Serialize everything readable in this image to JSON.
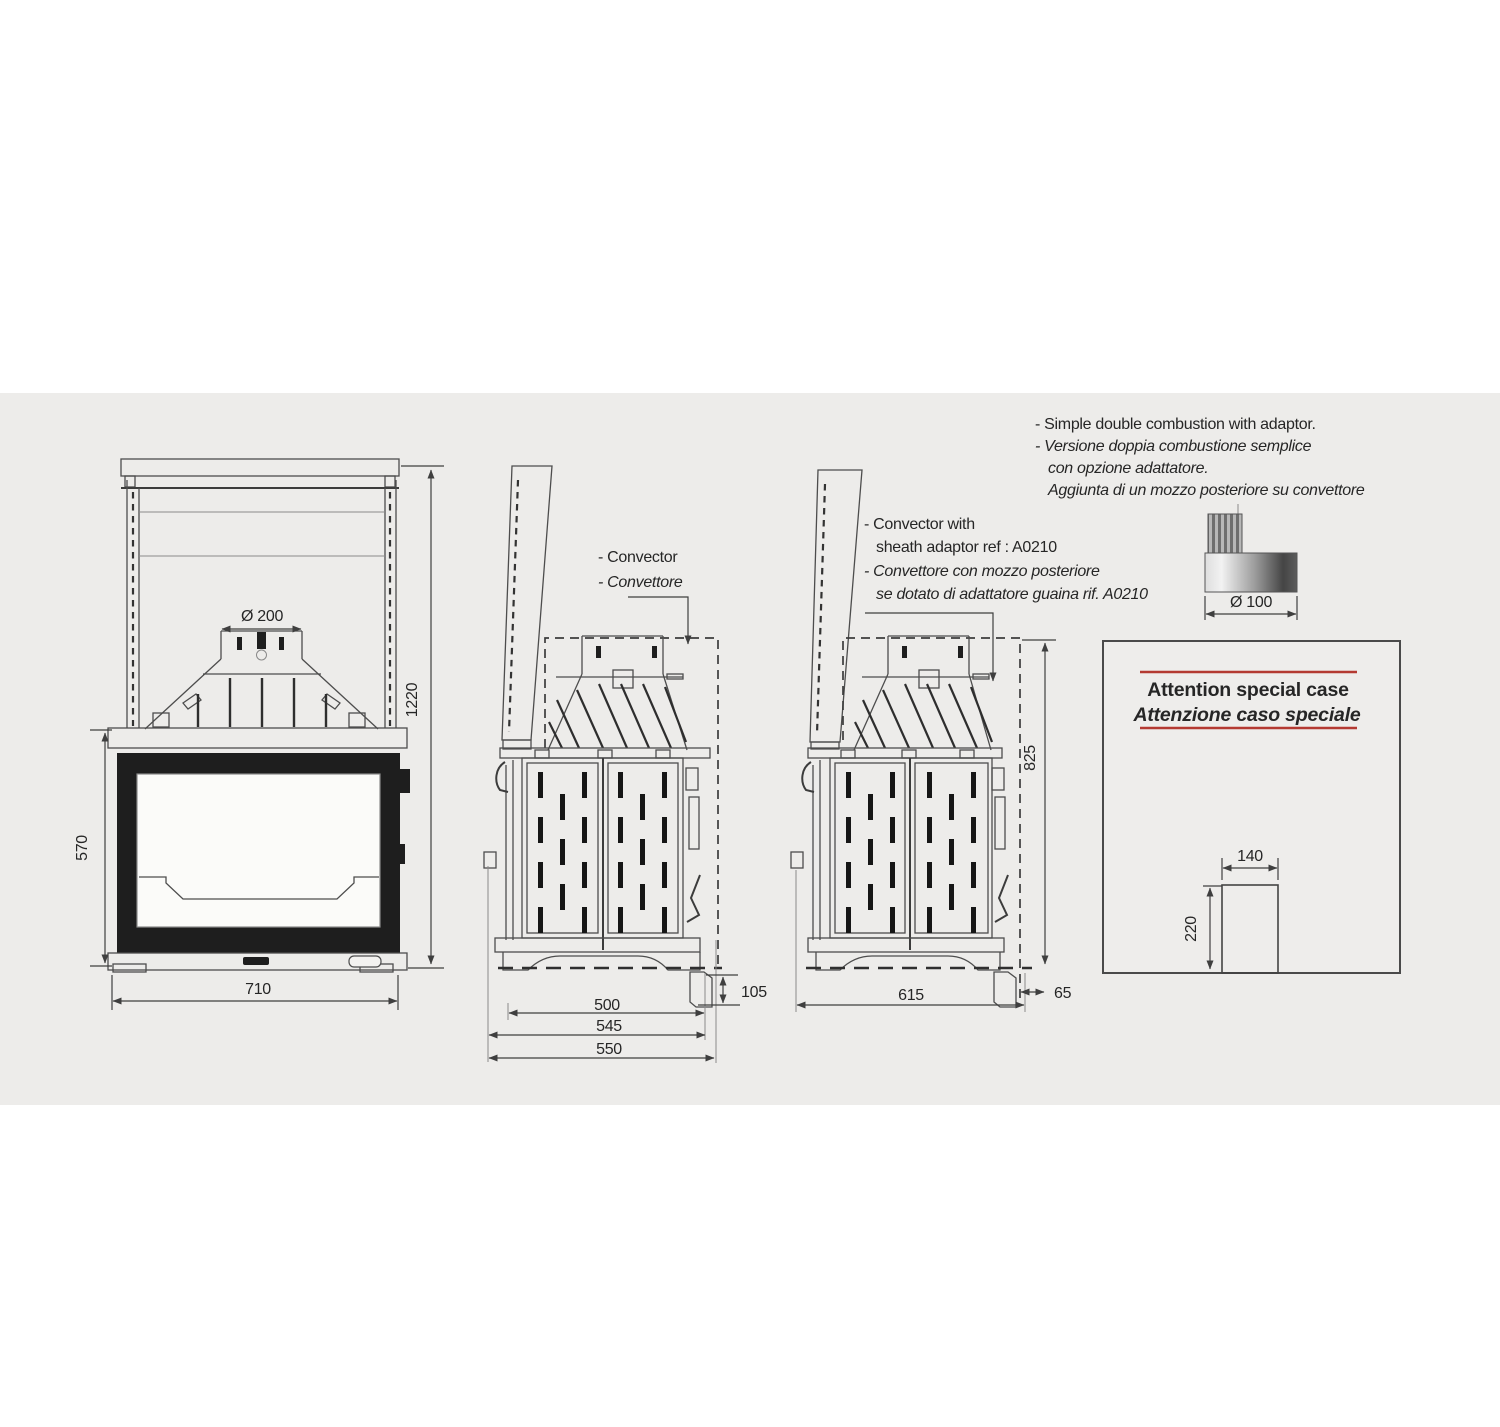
{
  "colors": {
    "panel_background": "#edecea",
    "ink": "#4d4d4d",
    "firebox_black": "#1e1e1e",
    "accent_red": "#b43a32"
  },
  "notes": {
    "combustion": {
      "line1": "- Simple double combustion with adaptor.",
      "line2": "- Versione doppia combustione semplice",
      "line3": "con opzione adattatore.",
      "line4": "Aggiunta di un mozzo posteriore su convettore"
    },
    "convector_adaptor": {
      "line1": "- Convector with",
      "line2": "sheath adaptor ref : A0210",
      "line3": "- Convettore  con mozzo posteriore",
      "line4": "se dotato di adattatore guaina  rif. A0210"
    },
    "convector": {
      "line1": "- Convector",
      "line2": "- Convettore"
    }
  },
  "adaptor": {
    "diameter": "Ø 100"
  },
  "front_view": {
    "flue_diameter": "Ø 200",
    "overall_height": "1220",
    "firebox_height": "570",
    "width": "710"
  },
  "side_view": {
    "depth_firebox": "500",
    "depth_mid": "545",
    "depth_overall": "550",
    "lever_drop": "105"
  },
  "side_view_adaptor": {
    "depth_overall": "615",
    "adaptor_offset": "65",
    "convector_height": "825"
  },
  "attention": {
    "title_en": "Attention special case",
    "title_it": "Attenzione caso speciale",
    "cutout_width": "140",
    "cutout_height": "220"
  }
}
